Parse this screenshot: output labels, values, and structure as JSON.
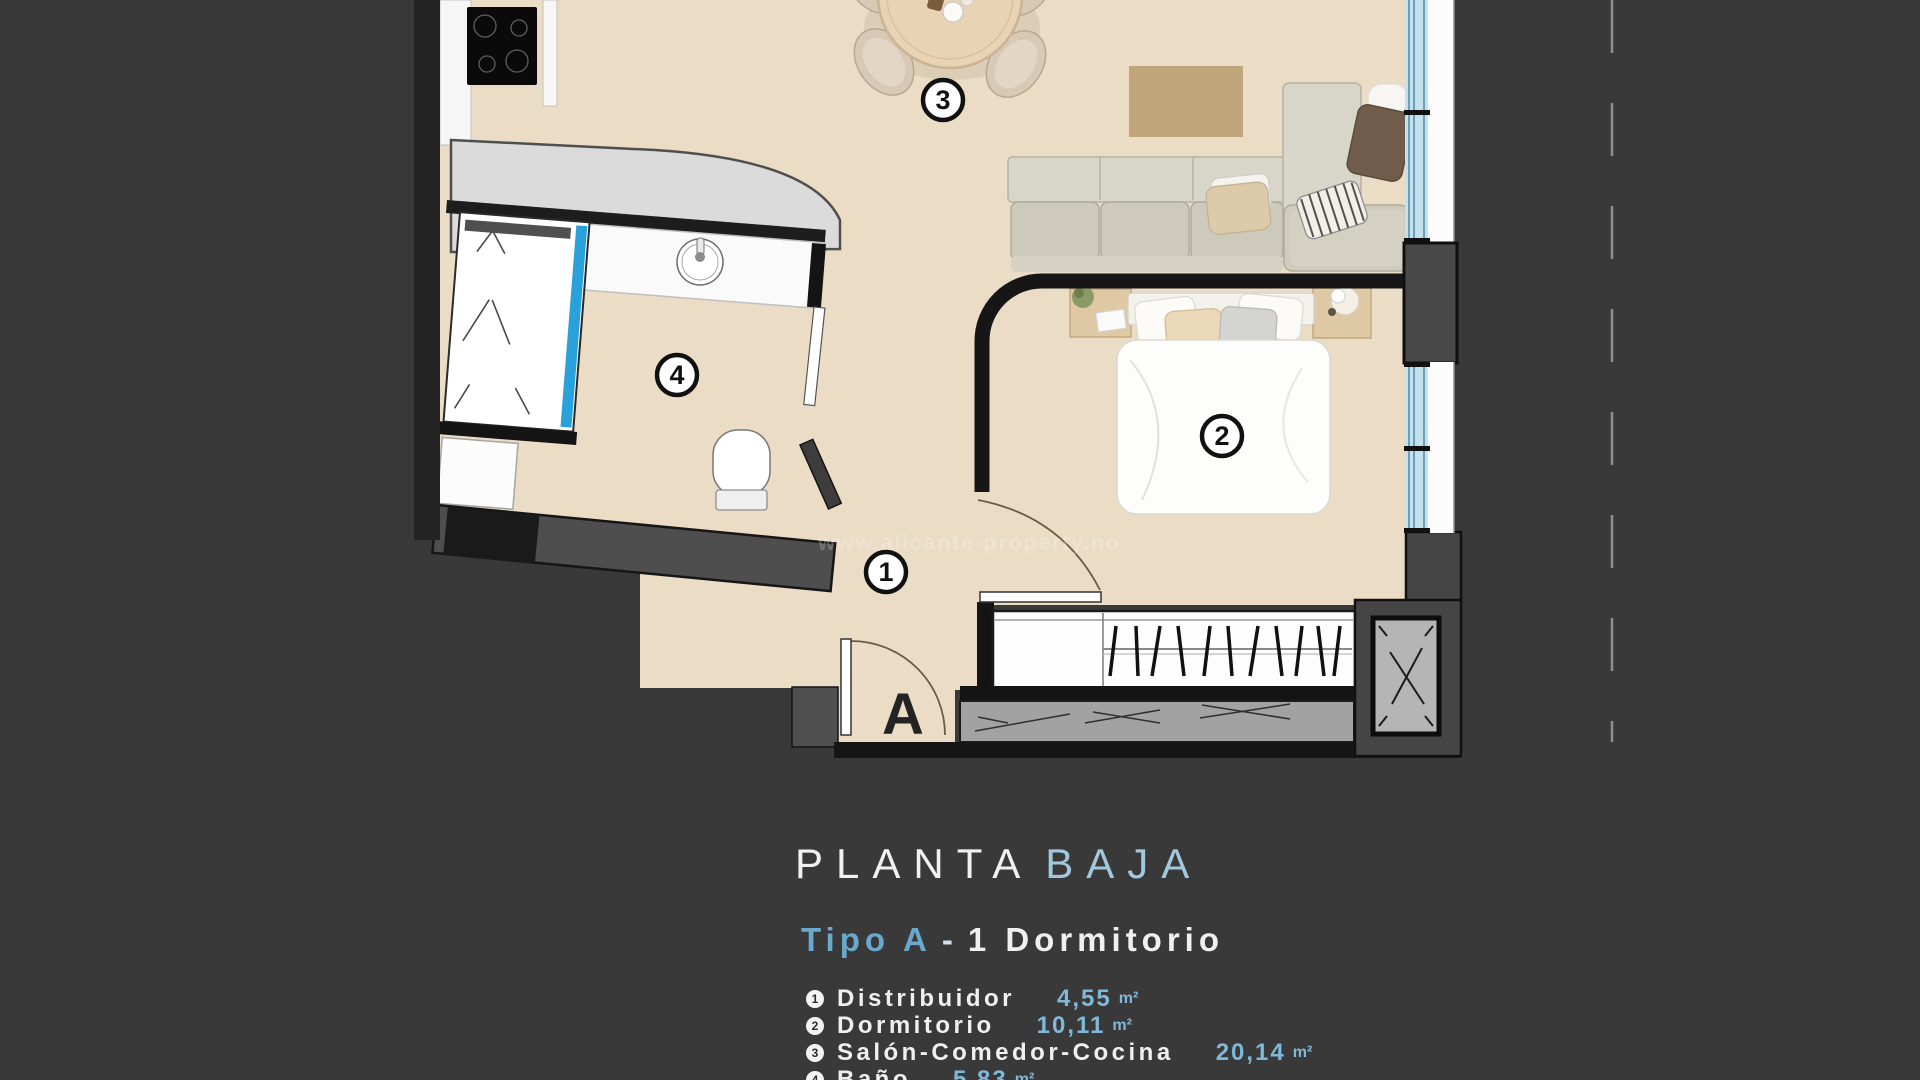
{
  "title": {
    "word1": "PLANTA",
    "word2": "BAJA"
  },
  "subtitle": {
    "type_label": "Tipo A",
    "separator": "-",
    "rest": "1  Dormitorio"
  },
  "legend": [
    {
      "num": "1",
      "label": "Distribuidor",
      "area": "4,55",
      "unit": "m²"
    },
    {
      "num": "2",
      "label": "Dormitorio",
      "area": "10,11",
      "unit": "m²"
    },
    {
      "num": "3",
      "label": "Salón-Comedor-Cocina",
      "area": "20,14",
      "unit": "m²"
    },
    {
      "num": "4",
      "label": "Baño",
      "area": "5,83",
      "unit": "m²"
    }
  ],
  "plan": {
    "watermark": "www.alicante-property.no",
    "entrance_label": "A",
    "badges": [
      {
        "num": "1",
        "room": "distribuidor"
      },
      {
        "num": "2",
        "room": "dormitorio"
      },
      {
        "num": "3",
        "room": "salon-comedor-cocina"
      },
      {
        "num": "4",
        "room": "bano"
      }
    ],
    "colors": {
      "background": "#393939",
      "floor": "#ebdcc5",
      "wall": "#161616",
      "counter_gray": "#dbdbdb",
      "glass_blue": "#c3e2f0",
      "shower_glass_blue": "#29a2db",
      "rug_tan": "#c2a67b",
      "sofa_beige": "#d8d6c8",
      "accent_title_blue": "#a3c7dc",
      "accent_value_blue": "#7fb8d8"
    }
  }
}
